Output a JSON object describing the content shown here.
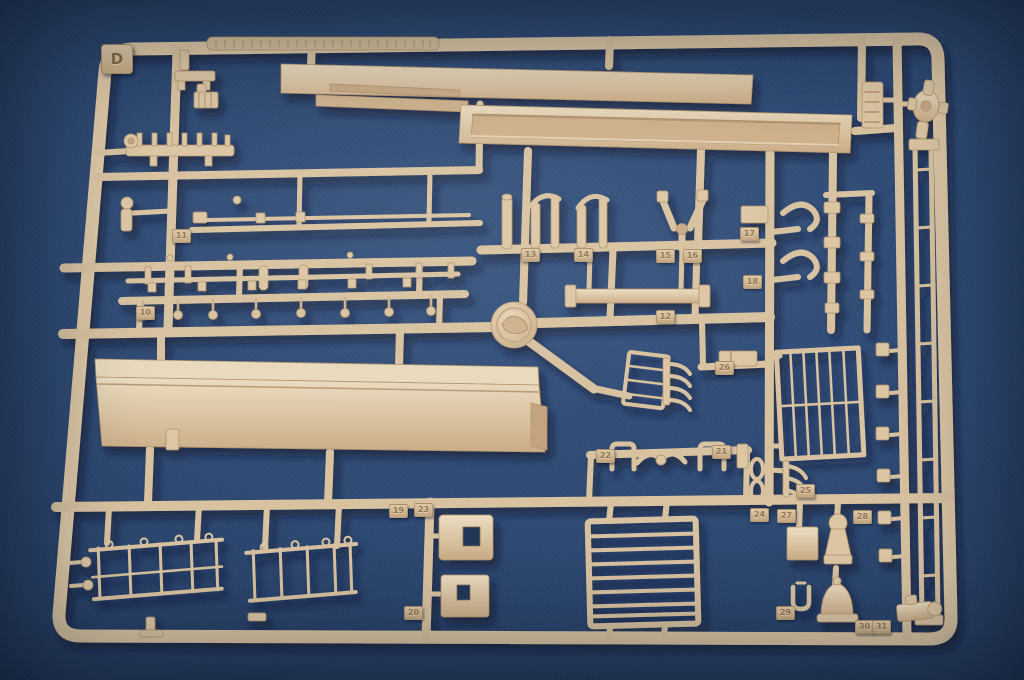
{
  "scene": {
    "description": "Photograph of a tan injection-molded plastic model-kit parts sprue (runner D) with numbered part tags, lying on a blue background",
    "background_color": "#2c4872",
    "plastic_color": "#dcc6a4",
    "plastic_highlight": "#ecddc1",
    "plastic_shadow": "#b2946f",
    "cast_shadow_color": "#081628"
  },
  "sprue": {
    "letter": "D",
    "part_tags": [
      {
        "label": "11",
        "x": 172,
        "y": 229
      },
      {
        "label": "10",
        "x": 136,
        "y": 306
      },
      {
        "label": "13",
        "x": 521,
        "y": 248
      },
      {
        "label": "14",
        "x": 574,
        "y": 248
      },
      {
        "label": "15",
        "x": 656,
        "y": 249
      },
      {
        "label": "16",
        "x": 683,
        "y": 249
      },
      {
        "label": "17",
        "x": 740,
        "y": 227
      },
      {
        "label": "18",
        "x": 743,
        "y": 275
      },
      {
        "label": "12",
        "x": 656,
        "y": 310
      },
      {
        "label": "26",
        "x": 715,
        "y": 361
      },
      {
        "label": "22",
        "x": 596,
        "y": 449
      },
      {
        "label": "21",
        "x": 712,
        "y": 445
      },
      {
        "label": "25",
        "x": 796,
        "y": 484
      },
      {
        "label": "19",
        "x": 389,
        "y": 504
      },
      {
        "label": "23",
        "x": 414,
        "y": 503
      },
      {
        "label": "24",
        "x": 750,
        "y": 508
      },
      {
        "label": "27",
        "x": 777,
        "y": 509
      },
      {
        "label": "28",
        "x": 853,
        "y": 510
      },
      {
        "label": "20",
        "x": 404,
        "y": 606
      },
      {
        "label": "29",
        "x": 776,
        "y": 606
      },
      {
        "label": "30",
        "x": 855,
        "y": 620
      },
      {
        "label": "31",
        "x": 872,
        "y": 620
      }
    ]
  }
}
